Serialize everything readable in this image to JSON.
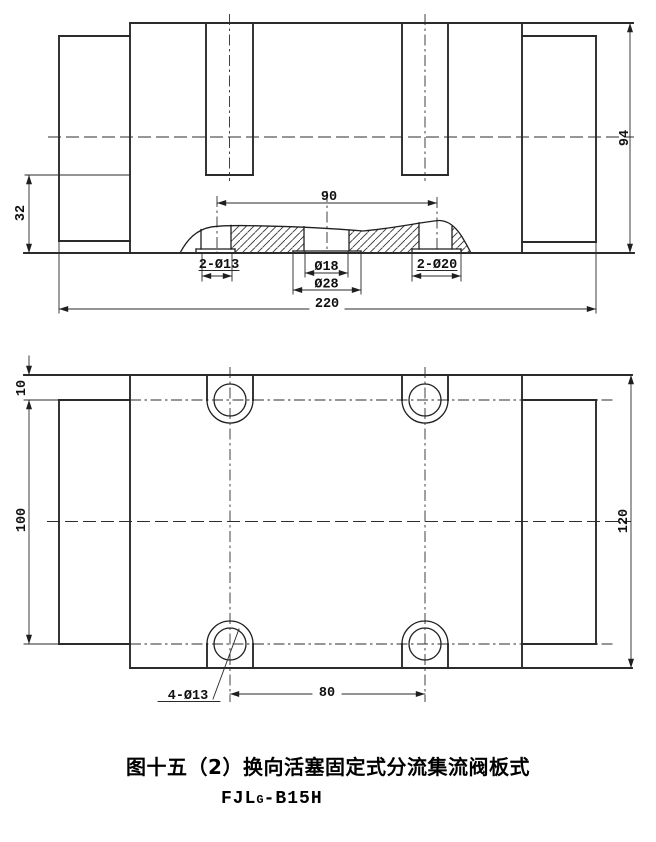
{
  "caption": {
    "title": "图十五（2）换向活塞固定式分流集流阀板式",
    "model_prefix": "FJL",
    "model_sub": "G",
    "model_suffix": "-B15H"
  },
  "section_view": {
    "dim_overall_width": "220",
    "dim_overall_height": "94",
    "dim_port_spacing": "90",
    "dim_port_face_height": "32",
    "callout_left_ports": "2-Ø13",
    "callout_center_port_inner": "Ø18",
    "callout_center_port_outer": "Ø28",
    "callout_right_ports": "2-Ø20"
  },
  "plan_view": {
    "dim_overall_height": "120",
    "dim_hole_top_offset": "10",
    "dim_hole_row_spacing": "100",
    "dim_hole_col_spacing": "80",
    "callout_bolt_holes": "4-Ø13"
  }
}
